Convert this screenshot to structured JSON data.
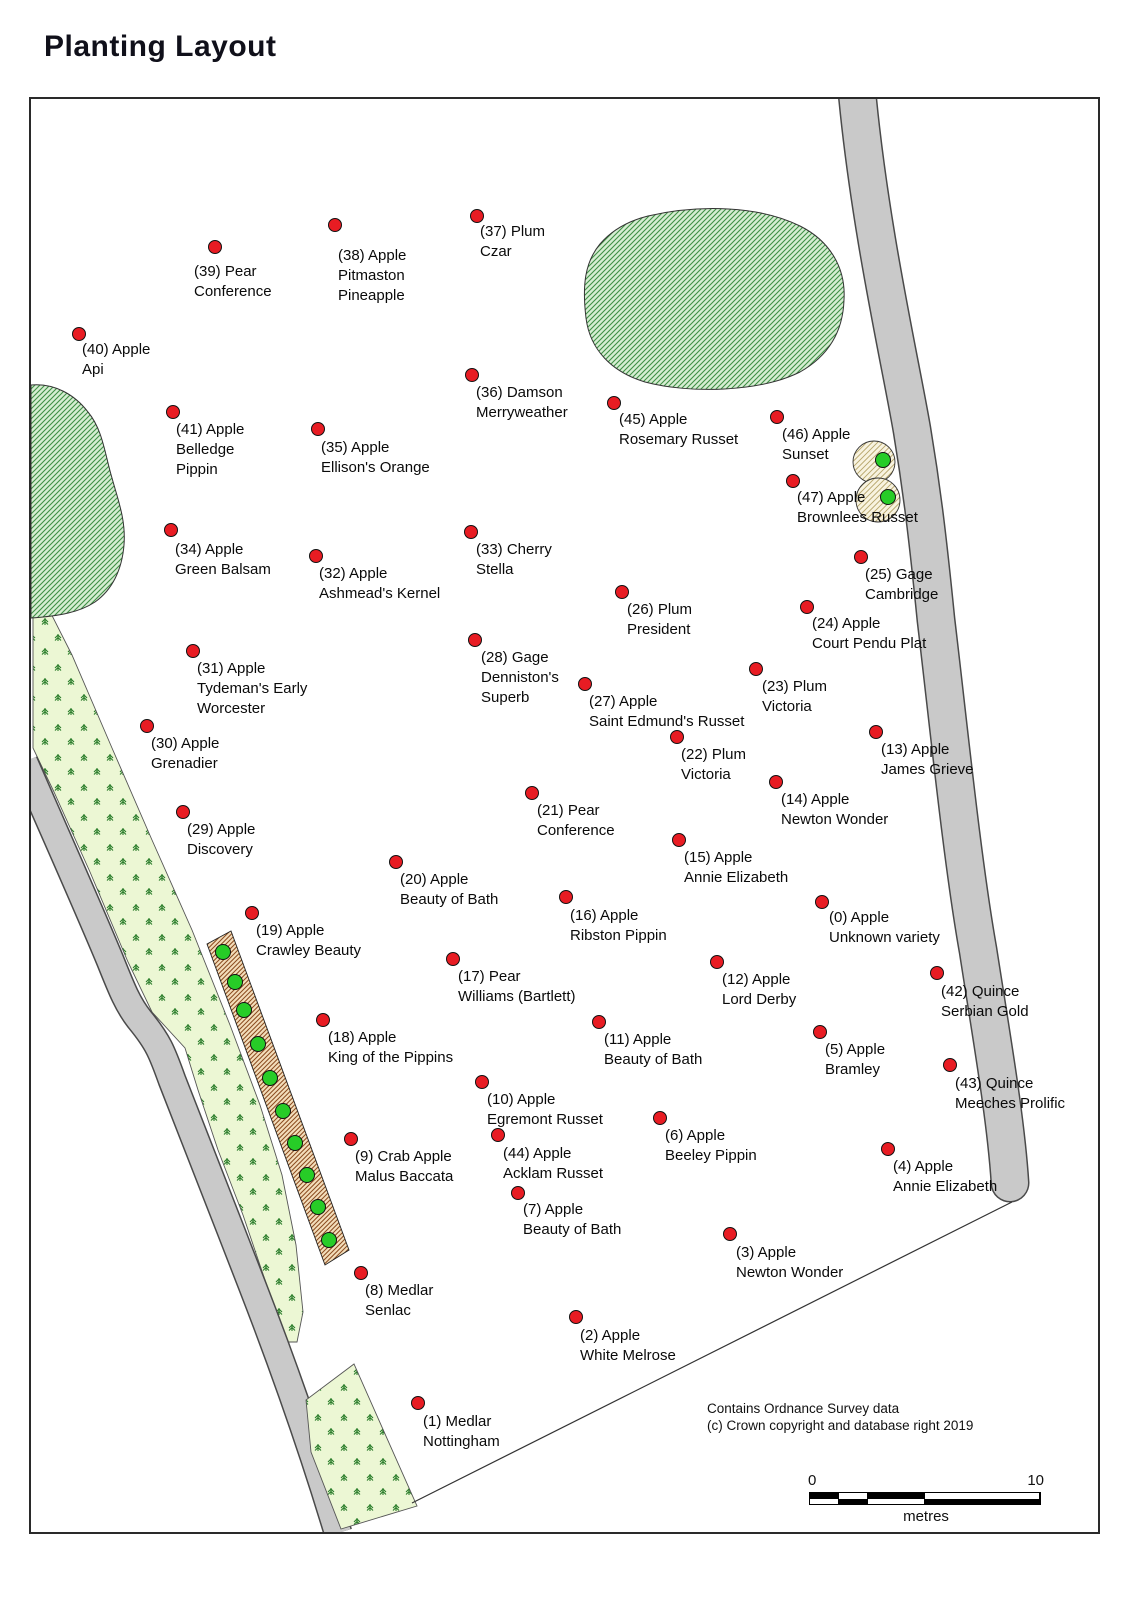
{
  "title": "Planting Layout",
  "copyright": {
    "line1": "Contains Ordnance Survey data",
    "line2": "(c) Crown copyright and database right 2019"
  },
  "scale_bar": {
    "start": "0",
    "end": "10",
    "unit": "metres"
  },
  "colors": {
    "tree_dot_red": "#e81c23",
    "planted_dot_green": "#27cc27",
    "pond_hatch_green": "#3f8f45",
    "hedge_hatch_brown": "#8a4a1e",
    "road_gray": "#c9c9c9",
    "conifer_green": "#2a7d2a"
  },
  "trees": [
    {
      "id": 0,
      "lines": [
        "(0) Apple",
        "Unknown variety"
      ],
      "dot": [
        822,
        902
      ],
      "label": [
        829,
        908
      ]
    },
    {
      "id": 1,
      "lines": [
        "(1) Medlar",
        "Nottingham"
      ],
      "dot": [
        418,
        1403
      ],
      "label": [
        423,
        1412
      ]
    },
    {
      "id": 2,
      "lines": [
        "(2) Apple",
        "White Melrose"
      ],
      "dot": [
        576,
        1317
      ],
      "label": [
        580,
        1326
      ]
    },
    {
      "id": 3,
      "lines": [
        "(3) Apple",
        "Newton Wonder"
      ],
      "dot": [
        730,
        1234
      ],
      "label": [
        736,
        1243
      ]
    },
    {
      "id": 4,
      "lines": [
        "(4) Apple",
        "Annie Elizabeth"
      ],
      "dot": [
        888,
        1149
      ],
      "label": [
        893,
        1157
      ]
    },
    {
      "id": 5,
      "lines": [
        "(5) Apple",
        "Bramley"
      ],
      "dot": [
        820,
        1032
      ],
      "label": [
        825,
        1040
      ]
    },
    {
      "id": 6,
      "lines": [
        "(6) Apple",
        "Beeley Pippin"
      ],
      "dot": [
        660,
        1118
      ],
      "label": [
        665,
        1126
      ]
    },
    {
      "id": 7,
      "lines": [
        "(7) Apple",
        "Beauty of Bath"
      ],
      "dot": [
        518,
        1193
      ],
      "label": [
        523,
        1200
      ]
    },
    {
      "id": 8,
      "lines": [
        "(8) Medlar",
        "Senlac"
      ],
      "dot": [
        361,
        1273
      ],
      "label": [
        365,
        1281
      ]
    },
    {
      "id": 9,
      "lines": [
        "(9) Crab Apple",
        "Malus Baccata"
      ],
      "dot": [
        351,
        1139
      ],
      "label": [
        355,
        1147
      ]
    },
    {
      "id": 10,
      "lines": [
        "(10) Apple",
        "Egremont Russet"
      ],
      "dot": [
        482,
        1082
      ],
      "label": [
        487,
        1090
      ]
    },
    {
      "id": 11,
      "lines": [
        "(11) Apple",
        "Beauty of Bath"
      ],
      "dot": [
        599,
        1022
      ],
      "label": [
        604,
        1030
      ]
    },
    {
      "id": 12,
      "lines": [
        "(12) Apple",
        "Lord Derby"
      ],
      "dot": [
        717,
        962
      ],
      "label": [
        722,
        970
      ]
    },
    {
      "id": 13,
      "lines": [
        "(13) Apple",
        "James Grieve"
      ],
      "dot": [
        876,
        732
      ],
      "label": [
        881,
        740
      ]
    },
    {
      "id": 14,
      "lines": [
        "(14) Apple",
        "Newton Wonder"
      ],
      "dot": [
        776,
        782
      ],
      "label": [
        781,
        790
      ]
    },
    {
      "id": 15,
      "lines": [
        "(15) Apple",
        "Annie Elizabeth"
      ],
      "dot": [
        679,
        840
      ],
      "label": [
        684,
        848
      ]
    },
    {
      "id": 16,
      "lines": [
        "(16) Apple",
        "Ribston Pippin"
      ],
      "dot": [
        566,
        897
      ],
      "label": [
        570,
        906
      ]
    },
    {
      "id": 17,
      "lines": [
        "(17) Pear",
        "Williams (Bartlett)"
      ],
      "dot": [
        453,
        959
      ],
      "label": [
        458,
        967
      ]
    },
    {
      "id": 18,
      "lines": [
        "(18) Apple",
        "King of the Pippins"
      ],
      "dot": [
        323,
        1020
      ],
      "label": [
        328,
        1028
      ]
    },
    {
      "id": 19,
      "lines": [
        "(19) Apple",
        "Crawley Beauty"
      ],
      "dot": [
        252,
        913
      ],
      "label": [
        256,
        921
      ]
    },
    {
      "id": 20,
      "lines": [
        "(20) Apple",
        "Beauty of Bath"
      ],
      "dot": [
        396,
        862
      ],
      "label": [
        400,
        870
      ]
    },
    {
      "id": 21,
      "lines": [
        "(21) Pear",
        "Conference"
      ],
      "dot": [
        532,
        793
      ],
      "label": [
        537,
        801
      ]
    },
    {
      "id": 22,
      "lines": [
        "(22) Plum",
        "Victoria"
      ],
      "dot": [
        677,
        737
      ],
      "label": [
        681,
        745
      ]
    },
    {
      "id": 23,
      "lines": [
        "(23) Plum",
        "Victoria"
      ],
      "dot": [
        756,
        669
      ],
      "label": [
        762,
        677
      ]
    },
    {
      "id": 24,
      "lines": [
        "(24) Apple",
        "Court Pendu Plat"
      ],
      "dot": [
        807,
        607
      ],
      "label": [
        812,
        614
      ]
    },
    {
      "id": 25,
      "lines": [
        "(25) Gage",
        "Cambridge"
      ],
      "dot": [
        861,
        557
      ],
      "label": [
        865,
        565
      ]
    },
    {
      "id": 26,
      "lines": [
        "(26) Plum",
        "President"
      ],
      "dot": [
        622,
        592
      ],
      "label": [
        627,
        600
      ]
    },
    {
      "id": 27,
      "lines": [
        "(27) Apple",
        "Saint Edmund's Russet"
      ],
      "dot": [
        585,
        684
      ],
      "label": [
        589,
        692
      ]
    },
    {
      "id": 28,
      "lines": [
        "(28) Gage",
        "Denniston's",
        "Superb"
      ],
      "dot": [
        475,
        640
      ],
      "label": [
        481,
        648
      ]
    },
    {
      "id": 29,
      "lines": [
        "(29) Apple",
        "Discovery"
      ],
      "dot": [
        183,
        812
      ],
      "label": [
        187,
        820
      ]
    },
    {
      "id": 30,
      "lines": [
        "(30) Apple",
        "Grenadier"
      ],
      "dot": [
        147,
        726
      ],
      "label": [
        151,
        734
      ]
    },
    {
      "id": 31,
      "lines": [
        "(31) Apple",
        "Tydeman's Early",
        "Worcester"
      ],
      "dot": [
        193,
        651
      ],
      "label": [
        197,
        659
      ]
    },
    {
      "id": 32,
      "lines": [
        "(32) Apple",
        "Ashmead's Kernel"
      ],
      "dot": [
        316,
        556
      ],
      "label": [
        319,
        564
      ]
    },
    {
      "id": 33,
      "lines": [
        "(33) Cherry",
        "Stella"
      ],
      "dot": [
        471,
        532
      ],
      "label": [
        476,
        540
      ]
    },
    {
      "id": 34,
      "lines": [
        "(34) Apple",
        "Green Balsam"
      ],
      "dot": [
        171,
        530
      ],
      "label": [
        175,
        540
      ]
    },
    {
      "id": 35,
      "lines": [
        "(35) Apple",
        "Ellison's Orange"
      ],
      "dot": [
        318,
        429
      ],
      "label": [
        321,
        438
      ]
    },
    {
      "id": 36,
      "lines": [
        "(36) Damson",
        "Merryweather"
      ],
      "dot": [
        472,
        375
      ],
      "label": [
        476,
        383
      ]
    },
    {
      "id": 37,
      "lines": [
        "(37) Plum",
        "Czar"
      ],
      "dot": [
        477,
        216
      ],
      "label": [
        480,
        222
      ]
    },
    {
      "id": 38,
      "lines": [
        "(38) Apple",
        "Pitmaston",
        "Pineapple"
      ],
      "dot": [
        335,
        225
      ],
      "label": [
        338,
        246
      ]
    },
    {
      "id": 39,
      "lines": [
        "(39) Pear",
        "Conference"
      ],
      "dot": [
        215,
        247
      ],
      "label": [
        194,
        262
      ]
    },
    {
      "id": 40,
      "lines": [
        "(40) Apple",
        "Api"
      ],
      "dot": [
        79,
        334
      ],
      "label": [
        82,
        340
      ]
    },
    {
      "id": 41,
      "lines": [
        "(41) Apple",
        "Belledge",
        "Pippin"
      ],
      "dot": [
        173,
        412
      ],
      "label": [
        176,
        420
      ]
    },
    {
      "id": 42,
      "lines": [
        "(42) Quince",
        "Serbian Gold"
      ],
      "dot": [
        937,
        973
      ],
      "label": [
        941,
        982
      ]
    },
    {
      "id": 43,
      "lines": [
        "(43) Quince",
        "Meeches Prolific"
      ],
      "dot": [
        950,
        1065
      ],
      "label": [
        955,
        1074
      ]
    },
    {
      "id": 44,
      "lines": [
        "(44) Apple",
        "Acklam Russet"
      ],
      "dot": [
        498,
        1135
      ],
      "label": [
        503,
        1144
      ]
    },
    {
      "id": 45,
      "lines": [
        "(45) Apple",
        "Rosemary Russet"
      ],
      "dot": [
        614,
        403
      ],
      "label": [
        619,
        410
      ]
    },
    {
      "id": 46,
      "lines": [
        "(46) Apple",
        "Sunset"
      ],
      "dot": [
        777,
        417
      ],
      "label": [
        782,
        425
      ]
    },
    {
      "id": 47,
      "lines": [
        "(47) Apple",
        "Brownlees Russet"
      ],
      "dot": [
        793,
        481
      ],
      "label": [
        797,
        488
      ]
    }
  ],
  "hedge_green_dots": [
    [
      223,
      952
    ],
    [
      235,
      982
    ],
    [
      244,
      1010
    ],
    [
      258,
      1044
    ],
    [
      270,
      1078
    ],
    [
      283,
      1111
    ],
    [
      295,
      1143
    ],
    [
      307,
      1175
    ],
    [
      318,
      1207
    ],
    [
      329,
      1240
    ]
  ],
  "roadside_green_dots": [
    [
      883,
      460
    ],
    [
      888,
      497
    ]
  ]
}
